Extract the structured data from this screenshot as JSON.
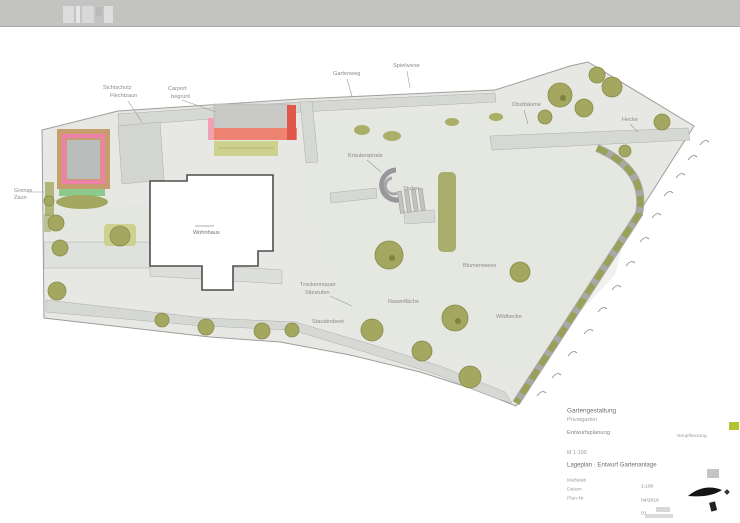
{
  "window": {
    "topbar_color": "#c3c3c1"
  },
  "plan": {
    "labels": [
      {
        "text": "Sichtschutz"
      },
      {
        "text": "Flechtzaun"
      },
      {
        "text": "Carport"
      },
      {
        "text": "begrünt"
      },
      {
        "text": "Gartenweg"
      },
      {
        "text": "Spielwiese"
      },
      {
        "text": "Obstbäume"
      },
      {
        "text": "Grenze"
      },
      {
        "text": "Zaun"
      },
      {
        "text": "Wohnhaus"
      },
      {
        "text": "Kräuterspirale"
      },
      {
        "text": "Stufen"
      },
      {
        "text": "Trockenmauer"
      },
      {
        "text": "Sitzstufen"
      },
      {
        "text": "Staudenbeet"
      },
      {
        "text": "Rasenfläche"
      },
      {
        "text": "Blumenwiese"
      },
      {
        "text": "Wildhecke"
      },
      {
        "text": "Hecke"
      }
    ],
    "colors": {
      "site_fill": "#e7e8e4",
      "path_fill": "#d6d8d4",
      "tree_green": "#a3a75f",
      "light_green": "#ccd28d",
      "hedge_olive": "#9aa055",
      "tan": "#c79d6e",
      "pink": "#ee82a6",
      "salmon": "#ee8372",
      "red": "#e2574b",
      "building_outline": "#4e4e4e"
    }
  },
  "titleblock": {
    "project_line1": "Gartengestaltung",
    "project_line2": "Privatgarten",
    "plan_type": "Entwurfsplanung",
    "scale_note": "M 1:100",
    "drawing_title": "Lageplan · Entwurf Gartenanlage",
    "fields": [
      {
        "label": "Maßstab",
        "value": "1:100"
      },
      {
        "label": "Datum",
        "value": "04/2016"
      },
      {
        "label": "Plan-Nr.",
        "value": "01"
      }
    ],
    "legend_label": "Neupflanzung",
    "legend_swatch_color": "#b5c234"
  }
}
